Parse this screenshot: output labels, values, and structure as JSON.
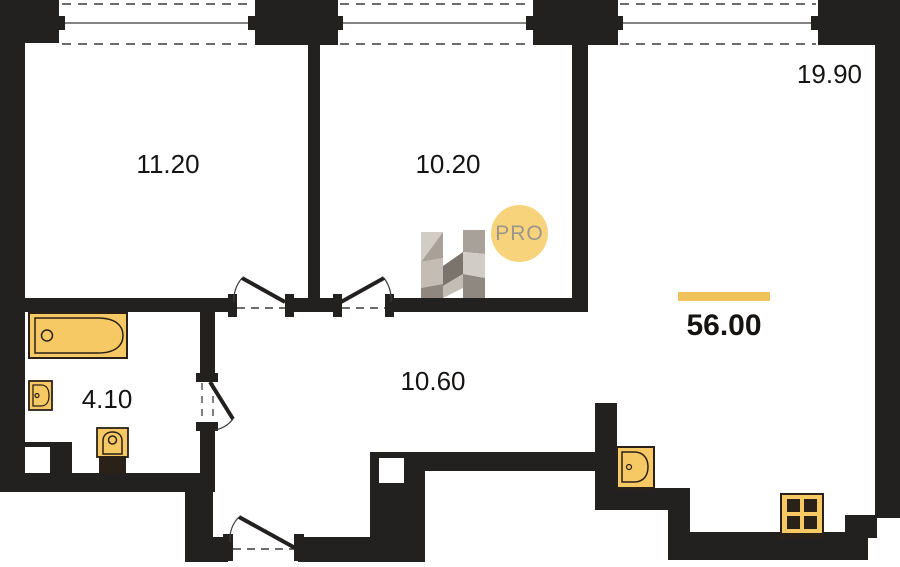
{
  "plan": {
    "rooms": [
      {
        "id": "room-11-20",
        "area": "11.20"
      },
      {
        "id": "room-10-20",
        "area": "10.20"
      },
      {
        "id": "room-19-90",
        "area": "19.90"
      },
      {
        "id": "bathroom",
        "area": "4.10"
      },
      {
        "id": "hallway",
        "area": "10.60"
      }
    ],
    "total_area": "56.00",
    "watermark": {
      "label": "PRO"
    },
    "fixtures": [
      "bathtub-icon",
      "bath-sink-icon",
      "toilet-icon",
      "kitchen-sink-icon",
      "stove-icon"
    ],
    "colors": {
      "wall": "#232020",
      "fixture_fill": "#F7C964",
      "fixture_border": "#2A2118",
      "accent_bar": "#F0C25A",
      "pro_circle": "#F7D47C",
      "pro_text": "#9C958D",
      "label": "#161412",
      "dash_line": "#3E3C3A",
      "logo_1": "#D2CCC6",
      "logo_2": "#A8A19A",
      "logo_3": "#C4BDB6",
      "logo_4": "#8F8881",
      "logo_5": "#7B746D"
    }
  }
}
